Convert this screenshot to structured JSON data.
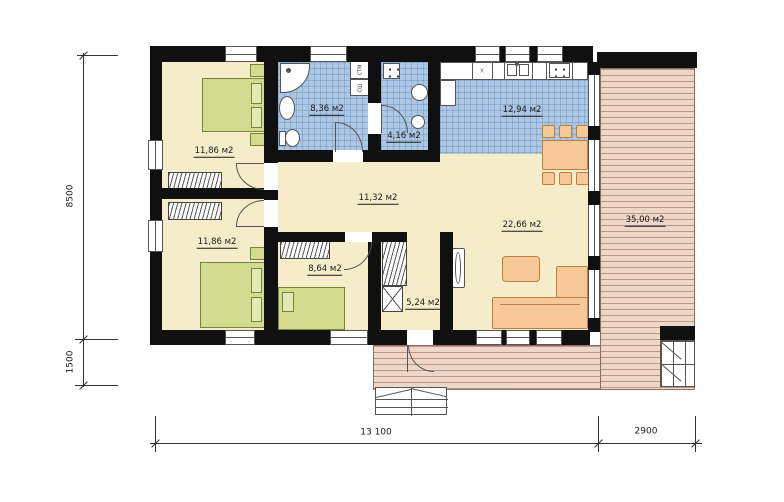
{
  "plan_title": "single-storey house floor plan",
  "labels": {
    "bedroom1": "11,86 м2",
    "bedroom2": "11,86 м2",
    "bathroom": "8,36 м2",
    "wc": "4,16 м2",
    "kitchen": "12,94 м2",
    "hall": "11,32 м2",
    "kidsroom": "8,64 м2",
    "corridor": "5,24 м2",
    "living": "22,66 м2",
    "terrace": "35,00 м2"
  },
  "dimensions": {
    "height_main": "8500",
    "height_porch": "1500",
    "width_main": "13 100",
    "width_terrace": "2900"
  },
  "appliances": {
    "washer": "СТМ",
    "dryer": "СШ",
    "hob_mark": "x"
  },
  "colors": {
    "wall": "#101010",
    "floor": "#f5edca",
    "tile": "#abc7e3",
    "deck": "#eed6c8",
    "bed": "#d3dc8e",
    "furniture": "#f8c998"
  }
}
